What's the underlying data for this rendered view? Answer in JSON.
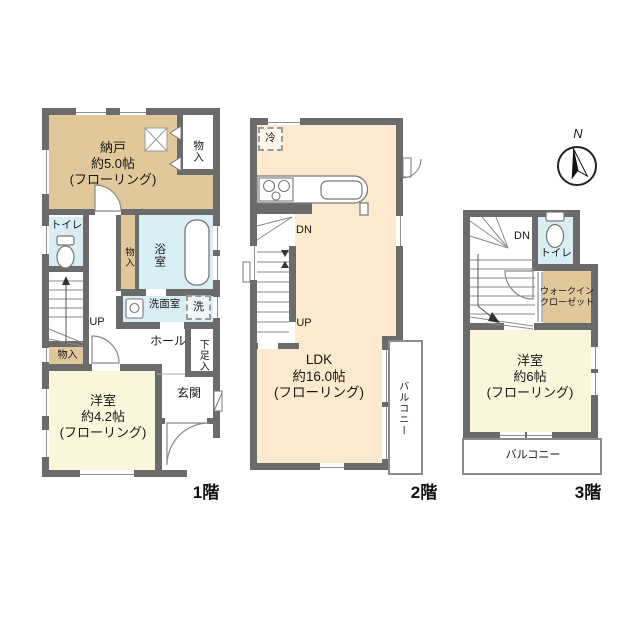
{
  "colors": {
    "wall": "#6b6b6b",
    "storage_tan": "#E0C89A",
    "ldk_cream": "#FBEACE",
    "room_yellow": "#FAF6DC",
    "wet_area_blue": "#D9EDF4"
  },
  "compass": {
    "label": "N"
  },
  "floor1": {
    "floor_label": "1階",
    "nando": {
      "name": "納戸",
      "size": "約5.0帖",
      "note": "(フローリング)"
    },
    "closet_top": "物入",
    "toilet": "トイレ",
    "closet_strip": "物入",
    "bath": "浴室",
    "washroom": "洗面室",
    "washer": "洗",
    "up": "UP",
    "hall": "ホール",
    "closet_bottom": "物入",
    "shoe_box": "下足入",
    "entrance": "玄関",
    "western_room": {
      "name": "洋室",
      "size": "約4.2帖",
      "note": "(フローリング)"
    }
  },
  "floor2": {
    "floor_label": "2階",
    "fridge": "冷",
    "down": "DN",
    "up": "UP",
    "ldk": {
      "name": "LDK",
      "size": "約16.0帖",
      "note": "(フローリング)"
    },
    "balcony": "バルコニー"
  },
  "floor3": {
    "floor_label": "3階",
    "down": "DN",
    "toilet": "トイレ",
    "walk_in_closet": {
      "line1": "ウォークイン",
      "line2": "クローゼット"
    },
    "western_room": {
      "name": "洋室",
      "size": "約6帖",
      "note": "(フローリング)"
    },
    "balcony": "バルコニー"
  }
}
